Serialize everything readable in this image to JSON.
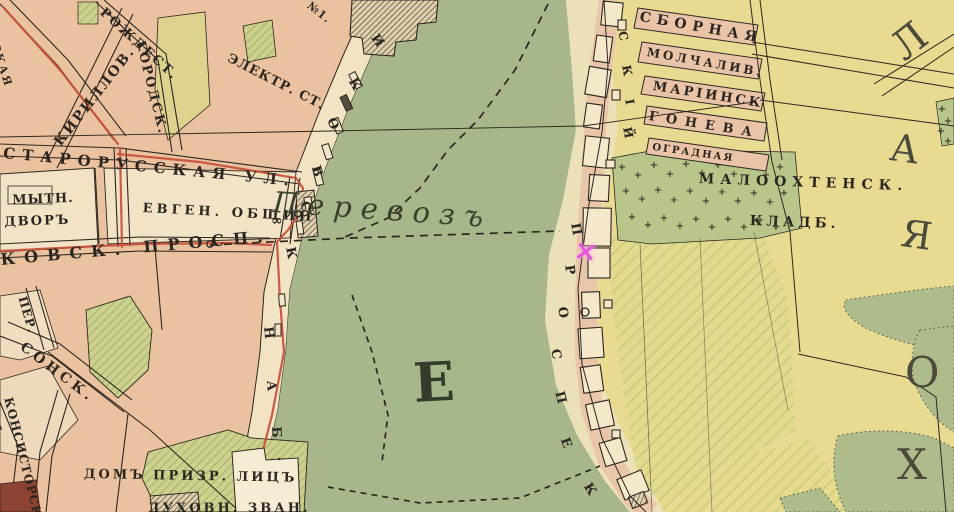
{
  "palette": {
    "ink": "#2b2620",
    "road_red": "#c8503a",
    "river_green": "#a8b78b",
    "city_peach": "#ebc2a0",
    "block_cream": "#f2e3c5",
    "right_sand": "#ece0b8",
    "fields_yellow": "#e8da90",
    "strip_pink": "#e9c4a8",
    "cemetery_green": "#b8c68a",
    "marsh_green": "#aebc8c",
    "garden_green": "#cdd18d",
    "marker_pink": "#e358d8"
  },
  "labels": [
    {
      "name": "street-starorusskaya",
      "text": "СТАРОРУССКАЯ УЛ.",
      "x": 4,
      "y": 146,
      "rot": 5.5,
      "fs": 15,
      "ls": 7
    },
    {
      "name": "street-kirillovskaya",
      "text": "КИРИЛЛОВ.",
      "x": 52,
      "y": 140,
      "rot": -52,
      "fs": 14,
      "ls": 2
    },
    {
      "name": "street-rozhdestvenskaya",
      "text": "РОЖДЕСТ.",
      "x": 106,
      "y": 6,
      "rot": 42,
      "fs": 13,
      "ls": 2
    },
    {
      "name": "street-gorodskaya",
      "text": "ГОРОДСК.",
      "x": 146,
      "y": 40,
      "rot": 76,
      "fs": 13,
      "ls": 2
    },
    {
      "name": "street-skaya",
      "text": "СКАЯ",
      "x": 0,
      "y": 42,
      "rot": 72,
      "fs": 11,
      "ls": 2
    },
    {
      "name": "building-no1",
      "text": "№1.",
      "x": 312,
      "y": 0,
      "rot": 38,
      "fs": 11,
      "ls": 1
    },
    {
      "name": "electric-station",
      "text": "ЭЛЕКТР. СТ.",
      "x": 231,
      "y": 52,
      "rot": 27,
      "fs": 13,
      "ls": 1
    },
    {
      "name": "mytny-dvor-line1",
      "text": "МЫТН.",
      "x": 12,
      "y": 194,
      "rot": -2,
      "fs": 13,
      "ls": 1
    },
    {
      "name": "mytny-dvor-line2",
      "text": "ДВОРЪ",
      "x": 4,
      "y": 216,
      "rot": -2,
      "fs": 13,
      "ls": 2
    },
    {
      "name": "evgen-obshchin",
      "text": "ЕВГЕН. ОБЩИН",
      "x": 143,
      "y": 202,
      "rot": 3,
      "fs": 13,
      "ls": 4
    },
    {
      "name": "infinity-symbol",
      "text": "∞",
      "x": 271,
      "y": 214,
      "rot": 0,
      "fs": 14,
      "ls": 0
    },
    {
      "name": "street-kovsk-prosp",
      "text": "КОВСК. ПРОСП.",
      "x": 0,
      "y": 252,
      "rot": -5,
      "fs": 16,
      "ls": 9
    },
    {
      "name": "street-per",
      "text": "ПЕР.",
      "x": 28,
      "y": 295,
      "rot": 74,
      "fs": 12,
      "ls": 1
    },
    {
      "name": "street-sonsk",
      "text": "СОНСК.",
      "x": 26,
      "y": 340,
      "rot": 37,
      "fs": 14,
      "ls": 4
    },
    {
      "name": "street-l",
      "text": "Л.",
      "x": 0,
      "y": 420,
      "rot": 70,
      "fs": 12,
      "ls": 0
    },
    {
      "name": "street-konsistorsk",
      "text": "КОНСИСТОРСК.",
      "x": 14,
      "y": 396,
      "rot": 76,
      "fs": 12,
      "ls": 1
    },
    {
      "name": "dom-prizreniya",
      "text": "ДОМЪ ПРИЗР. ЛИЦЪ",
      "x": 84,
      "y": 468,
      "rot": 1,
      "fs": 13,
      "ls": 3
    },
    {
      "name": "dukhovn-zvan",
      "text": "ДУХОВН. ЗВАН.",
      "x": 148,
      "y": 502,
      "rot": 0,
      "fs": 13,
      "ls": 3
    },
    {
      "name": "ferry-perevoz",
      "text": "Перевозъ",
      "x": 274,
      "y": 188,
      "rot": 4,
      "fs": 29,
      "ls": 9,
      "it": true,
      "w": 400,
      "color": "#39412c"
    },
    {
      "name": "river-letter-e",
      "text": "Е",
      "x": 412,
      "y": 356,
      "rot": -3,
      "fs": 54,
      "ls": 0,
      "color": "#333b2b"
    },
    {
      "name": "embankment-letter-i",
      "text": "И",
      "x": 379,
      "y": 32,
      "rot": 55,
      "fs": 13
    },
    {
      "name": "embankment-letter-k1",
      "text": "К",
      "x": 357,
      "y": 76,
      "rot": 60,
      "fs": 13
    },
    {
      "name": "embankment-letter-o",
      "text": "О",
      "x": 336,
      "y": 116,
      "rot": 66,
      "fs": 13
    },
    {
      "name": "embankment-letter-v",
      "text": "В",
      "x": 321,
      "y": 164,
      "rot": 72,
      "fs": 13
    },
    {
      "name": "embankment-letter-s",
      "text": "С",
      "x": 310,
      "y": 200,
      "rot": 76,
      "fs": 13
    },
    {
      "name": "embankment-letter-k2",
      "text": "К",
      "x": 296,
      "y": 246,
      "rot": 80,
      "fs": 13
    },
    {
      "name": "embankment-letter-n",
      "text": "Н",
      "x": 274,
      "y": 326,
      "rot": 84,
      "fs": 13
    },
    {
      "name": "embankment-letter-a",
      "text": "А",
      "x": 277,
      "y": 380,
      "rot": 86,
      "fs": 13
    },
    {
      "name": "embankment-letter-b",
      "text": "Б",
      "x": 282,
      "y": 426,
      "rot": 86,
      "fs": 13
    },
    {
      "name": "embankment-letter-dot",
      "text": ".",
      "x": 288,
      "y": 456,
      "rot": 86,
      "fs": 13
    },
    {
      "name": "malookhtensky-letter-s",
      "text": "С",
      "x": 628,
      "y": 30,
      "rot": 78,
      "fs": 12
    },
    {
      "name": "malookhtensky-letter-k",
      "text": "К",
      "x": 632,
      "y": 64,
      "rot": 80,
      "fs": 12
    },
    {
      "name": "malookhtensky-letter-i",
      "text": "І",
      "x": 635,
      "y": 98,
      "rot": 80,
      "fs": 12
    },
    {
      "name": "malookhtensky-letter-y",
      "text": "Й",
      "x": 633,
      "y": 126,
      "rot": 80,
      "fs": 12
    },
    {
      "name": "prospekt-letter-p1",
      "text": "П",
      "x": 581,
      "y": 222,
      "rot": 80,
      "fs": 13
    },
    {
      "name": "prospekt-letter-r",
      "text": "Р",
      "x": 575,
      "y": 264,
      "rot": 82,
      "fs": 13
    },
    {
      "name": "prospekt-letter-o",
      "text": "О",
      "x": 568,
      "y": 306,
      "rot": 82,
      "fs": 13
    },
    {
      "name": "prospekt-letter-s",
      "text": "С",
      "x": 561,
      "y": 348,
      "rot": 80,
      "fs": 13
    },
    {
      "name": "prospekt-letter-p2",
      "text": "П",
      "x": 565,
      "y": 390,
      "rot": 76,
      "fs": 13
    },
    {
      "name": "prospekt-letter-e",
      "text": "Е",
      "x": 570,
      "y": 436,
      "rot": 70,
      "fs": 13
    },
    {
      "name": "prospekt-letter-k",
      "text": "К",
      "x": 592,
      "y": 481,
      "rot": 58,
      "fs": 13
    },
    {
      "name": "street-sbornaya",
      "text": "СБОРНАЯ",
      "x": 641,
      "y": 10,
      "rot": 10,
      "fs": 14,
      "ls": 6
    },
    {
      "name": "street-molchaliv",
      "text": "МОЛЧАЛИВ.",
      "x": 648,
      "y": 46,
      "rot": 10,
      "fs": 12,
      "ls": 3
    },
    {
      "name": "street-mariinsk",
      "text": "МАРІИНСК",
      "x": 654,
      "y": 80,
      "rot": 9,
      "fs": 13,
      "ls": 3
    },
    {
      "name": "street-goneva",
      "text": "ГОНЕВА",
      "x": 650,
      "y": 110,
      "rot": 9,
      "fs": 13,
      "ls": 8
    },
    {
      "name": "street-ogradnaya",
      "text": "ОГРАДНАЯ",
      "x": 653,
      "y": 143,
      "rot": 8,
      "fs": 10,
      "ls": 2
    },
    {
      "name": "cemetery-name-line1",
      "text": "МАЛООХТЕНСК.",
      "x": 699,
      "y": 172,
      "rot": 2,
      "fs": 14,
      "ls": 6
    },
    {
      "name": "cemetery-name-line2",
      "text": "КЛАДБ.",
      "x": 750,
      "y": 214,
      "rot": 2,
      "fs": 14,
      "ls": 4
    },
    {
      "name": "district-letter-l",
      "text": "Л",
      "x": 884,
      "y": 36,
      "rot": -38,
      "fs": 40,
      "w": 400,
      "color": "#4a4a3b"
    },
    {
      "name": "district-letter-a",
      "text": "А",
      "x": 893,
      "y": 128,
      "rot": 8,
      "fs": 38,
      "w": 400,
      "color": "#4a4a3b"
    },
    {
      "name": "district-letter-ya",
      "text": "Я",
      "x": 904,
      "y": 214,
      "rot": 8,
      "fs": 38,
      "w": 400,
      "color": "#4a4a3b"
    },
    {
      "name": "district-letter-o",
      "text": "О",
      "x": 905,
      "y": 352,
      "rot": 0,
      "fs": 42,
      "w": 400,
      "color": "#4a4a3b"
    },
    {
      "name": "district-letter-kh",
      "text": "Х",
      "x": 897,
      "y": 444,
      "rot": 0,
      "fs": 42,
      "w": 400,
      "color": "#4a4a3b"
    },
    {
      "name": "church-marker",
      "text": "×",
      "x": 576,
      "y": 236,
      "rot": 8,
      "fs": 28,
      "color": "#e358d8",
      "cls": "glow"
    }
  ],
  "cemetery_crosses": {
    "symbol": "+",
    "positions": [
      [
        622,
        170
      ],
      [
        638,
        178
      ],
      [
        654,
        168
      ],
      [
        670,
        177
      ],
      [
        686,
        167
      ],
      [
        702,
        176
      ],
      [
        718,
        168
      ],
      [
        734,
        177
      ],
      [
        750,
        169
      ],
      [
        766,
        178
      ],
      [
        780,
        170
      ],
      [
        626,
        194
      ],
      [
        642,
        202
      ],
      [
        658,
        193
      ],
      [
        674,
        203
      ],
      [
        690,
        194
      ],
      [
        706,
        204
      ],
      [
        722,
        195
      ],
      [
        738,
        204
      ],
      [
        754,
        196
      ],
      [
        770,
        205
      ],
      [
        784,
        196
      ],
      [
        632,
        220
      ],
      [
        648,
        228
      ],
      [
        664,
        221
      ],
      [
        680,
        229
      ],
      [
        696,
        222
      ],
      [
        712,
        230
      ],
      [
        728,
        222
      ],
      [
        744,
        230
      ],
      [
        760,
        223
      ],
      [
        776,
        230
      ],
      [
        942,
        112
      ],
      [
        948,
        124
      ],
      [
        941,
        134
      ],
      [
        948,
        144
      ]
    ]
  }
}
